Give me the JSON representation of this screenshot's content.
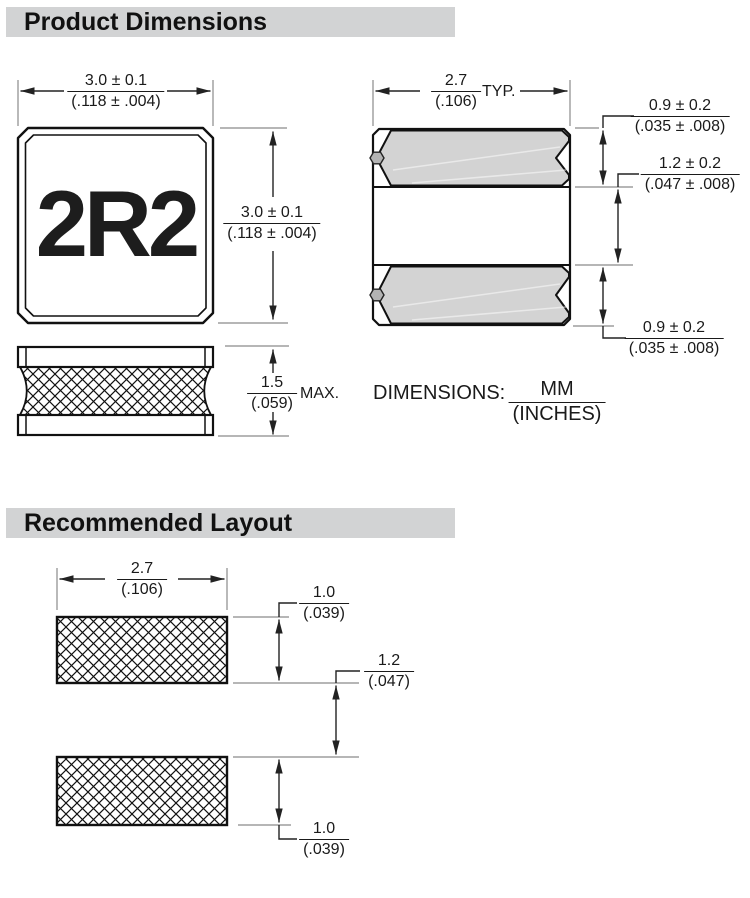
{
  "sections": {
    "product_dimensions": {
      "title": "Product Dimensions"
    },
    "recommended_layout": {
      "title": "Recommended Layout"
    }
  },
  "top_view": {
    "part_marking": "2R2"
  },
  "dims": {
    "body_width": {
      "mm": "3.0 ± 0.1",
      "in": "(.118 ± .004)"
    },
    "body_height": {
      "mm": "3.0 ± 0.1",
      "in": "(.118 ± .004)"
    },
    "thickness": {
      "mm": "1.5",
      "in": "(.059)",
      "qualifier": "MAX."
    },
    "pad_width": {
      "mm": "2.7",
      "in": "(.106)",
      "qualifier": "TYP."
    },
    "pad_top_height": {
      "mm": "0.9 ± 0.2",
      "in": "(.035 ± .008)"
    },
    "pad_gap": {
      "mm": "1.2 ± 0.2",
      "in": "(.047 ± .008)"
    },
    "pad_bottom_height": {
      "mm": "0.9 ± 0.2",
      "in": "(.035 ± .008)"
    },
    "units_note": {
      "label": "DIMENSIONS:",
      "num": "MM",
      "den": "(INCHES)"
    }
  },
  "layout": {
    "pad_width": {
      "mm": "2.7",
      "in": "(.106)"
    },
    "pad_top_height": {
      "mm": "1.0",
      "in": "(.039)"
    },
    "pad_gap": {
      "mm": "1.2",
      "in": "(.047)"
    },
    "pad_bottom_height": {
      "mm": "1.0",
      "in": "(.039)"
    }
  },
  "colors": {
    "header_bar": "#d2d3d4",
    "pad_fill": "#d3d3d3",
    "outline": "#111111",
    "dim_line": "#222222",
    "ext_line": "#8a8a8a"
  }
}
